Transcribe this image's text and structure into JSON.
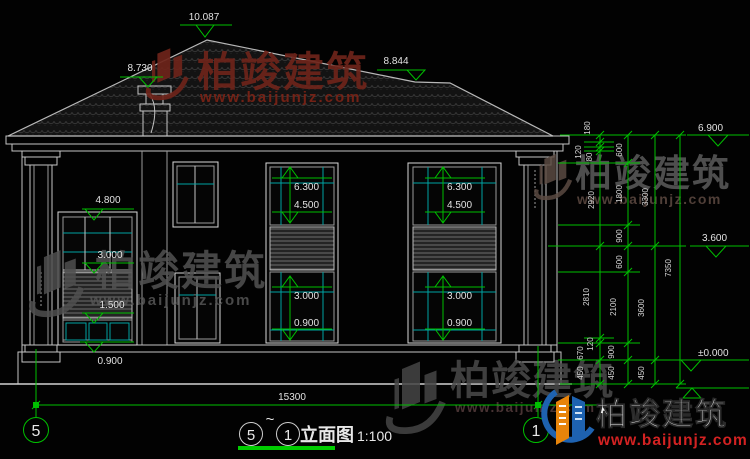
{
  "marks": {
    "peak": "10.087",
    "chimney": "8.730",
    "hip": "8.844",
    "eave": "6.900",
    "floor2": "3.600",
    "zero": "±0.000",
    "bay_top": "4.800",
    "bay_mid": "3.000",
    "bay_rail": "1.500",
    "bay_sill": "0.900",
    "w2_head": "6.300",
    "w2_sill": "4.500",
    "w1_head": "3.000",
    "w1_sill": "0.900"
  },
  "chains": {
    "inner": [
      "180",
      "120",
      "80",
      "2920",
      "2810",
      "120",
      "670",
      "450"
    ],
    "mid": [
      "600",
      "1800",
      "900",
      "600",
      "2100",
      "900",
      "450"
    ],
    "outer": [
      "3300",
      "3600",
      "450"
    ],
    "total": "7350"
  },
  "bottom": {
    "overall": "15300"
  },
  "axes": {
    "left": "5",
    "right": "1"
  },
  "titleblock": {
    "start_axis": "5",
    "tilde": "~",
    "end_axis": "1",
    "name": "立面图",
    "scale": "1:100"
  },
  "brand": {
    "name": "柏竣建筑",
    "url": "www.baijunjz.com"
  },
  "colors": {
    "annotation_green": "#00c000",
    "window_cyan": "#00a3a3",
    "watermark_red": "#6e241a",
    "watermark_grey": "#515151",
    "logo_blue": "#1e62b0",
    "logo_orange": "#e8840a",
    "logo_url_red": "#d32222"
  }
}
